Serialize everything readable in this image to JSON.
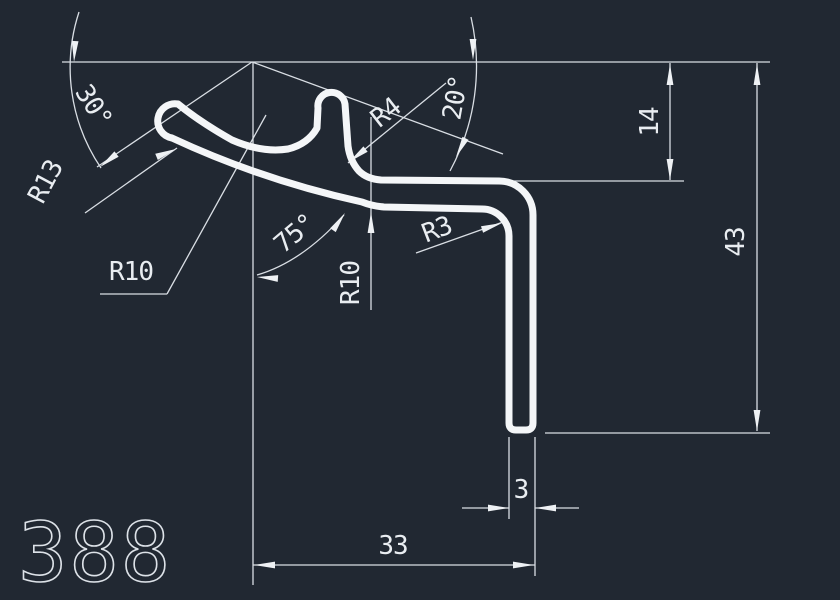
{
  "drawing": {
    "part_number": "388",
    "labels": {
      "angle_30": "30°",
      "angle_75": "75°",
      "angle_20": "20°",
      "r13": "R13",
      "r10_left": "R10",
      "r10_mid": "R10",
      "r4": "R4",
      "r3": "R3",
      "len_14": "14",
      "len_43": "43",
      "len_3": "3",
      "len_33": "33"
    },
    "dimensions": [
      {
        "type": "angular",
        "value": 30,
        "unit": "deg",
        "label": "30°"
      },
      {
        "type": "angular",
        "value": 75,
        "unit": "deg",
        "label": "75°"
      },
      {
        "type": "angular",
        "value": 20,
        "unit": "deg",
        "label": "20°"
      },
      {
        "type": "radius",
        "value": 13,
        "label": "R13"
      },
      {
        "type": "radius",
        "value": 10,
        "label": "R10"
      },
      {
        "type": "radius",
        "value": 10,
        "label": "R10"
      },
      {
        "type": "radius",
        "value": 4,
        "label": "R4"
      },
      {
        "type": "radius",
        "value": 3,
        "label": "R3"
      },
      {
        "type": "linear",
        "value": 14,
        "label": "14"
      },
      {
        "type": "linear",
        "value": 43,
        "label": "43"
      },
      {
        "type": "linear",
        "value": 3,
        "label": "3"
      },
      {
        "type": "linear",
        "value": 33,
        "label": "33"
      }
    ],
    "colors": {
      "background": "#212832",
      "dimension_lines": "#d9dee4",
      "profile_outline": "#f4f6f8",
      "text": "#e9edf1"
    }
  }
}
